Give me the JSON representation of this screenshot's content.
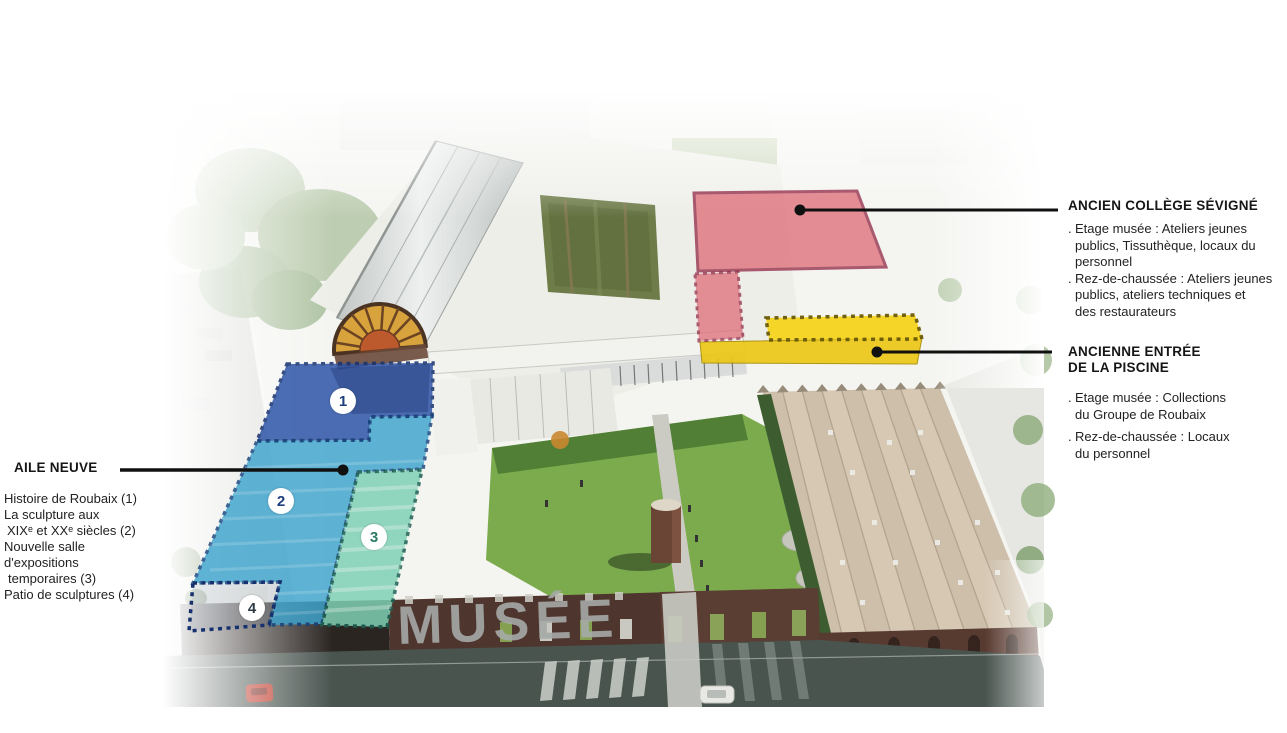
{
  "diagram_title": "Plan annoté du musée La Piscine (vue aérienne)",
  "building_sign": "MUSÉE",
  "legend": {
    "aile_neuve": {
      "title": "AILE NEUVE",
      "lines": [
        "Histoire de Roubaix (1)",
        "La sculpture aux",
        "XIXᵉ et XXᵉ siècles (2)",
        "Nouvelle salle",
        "d'expositions",
        "temporaires (3)",
        "Patio de sculptures (4)"
      ]
    },
    "ancien_college": {
      "title": "ANCIEN COLLÈGE SÉVIGNÉ",
      "items": [
        {
          "bullet": ".",
          "lines": [
            "Etage musée : Ateliers jeunes",
            "publics, Tissuthèque, locaux du",
            "personnel"
          ]
        },
        {
          "bullet": ".",
          "lines": [
            "Rez-de-chaussée : Ateliers jeunes",
            "publics, ateliers techniques et",
            "des restaurateurs"
          ]
        }
      ]
    },
    "ancienne_entree": {
      "title_line1": "ANCIENNE ENTRÉE",
      "title_line2": "DE LA PISCINE",
      "items": [
        {
          "bullet": ".",
          "lines": [
            "Etage musée : Collections",
            "du Groupe de Roubaix"
          ]
        },
        {
          "bullet": ".",
          "lines": [
            "Rez-de-chaussée : Locaux",
            "du personnel"
          ]
        }
      ]
    }
  },
  "markers": [
    {
      "label": "1"
    },
    {
      "label": "2"
    },
    {
      "label": "3"
    },
    {
      "label": "4"
    }
  ],
  "zone_colors": {
    "zone1_blue": "#2e55a8",
    "zone2_cyan": "#3da4cd",
    "zone3_mint": "#7fd0b4",
    "blue_border": "#16316e",
    "mint_border": "#1c6153",
    "red_fill": "#dd6570",
    "red_border": "#8c1f3e",
    "yellow_fill": "#f6d41d",
    "yellow_border": "#6a5a06",
    "leader_line": "#101010"
  }
}
